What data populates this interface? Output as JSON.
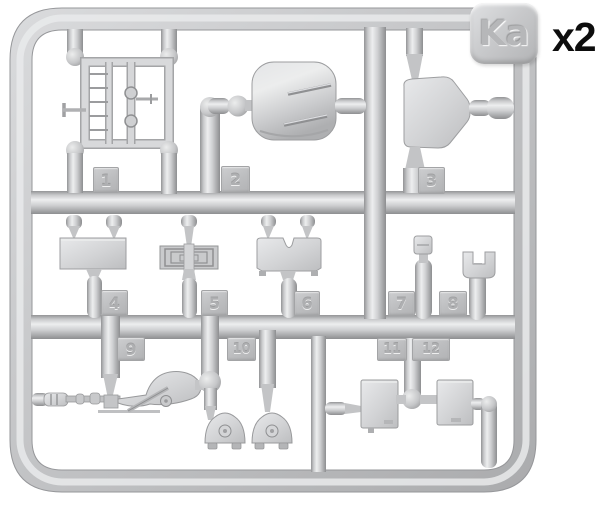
{
  "sprue": {
    "label": "Ka",
    "multiplier": "x2",
    "part_numbers": [
      "1",
      "2",
      "3",
      "4",
      "5",
      "6",
      "7",
      "8",
      "9",
      "10",
      "11",
      "12"
    ],
    "colors": {
      "background": "#ffffff",
      "plastic_mid": "#c6c7c9",
      "plastic_highlight": "#ecedef",
      "plastic_shadow": "#919294",
      "number_tab": "#bfc0c2",
      "embossed_text": "#aeafb1",
      "multiplier_text": "#0d0d0d"
    }
  }
}
